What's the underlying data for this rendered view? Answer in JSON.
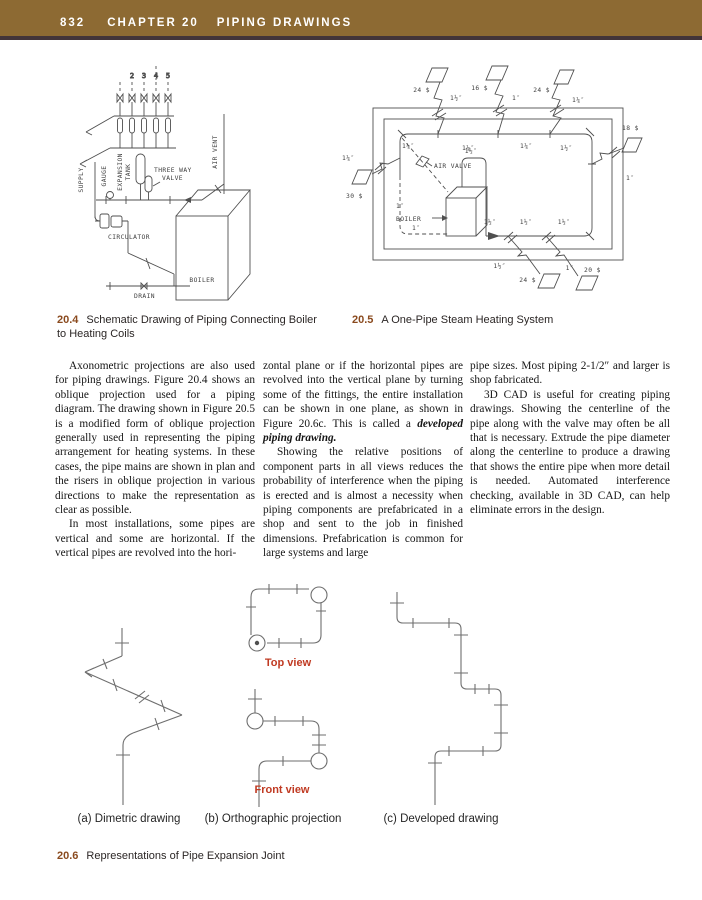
{
  "header": {
    "page": "832",
    "chapter": "CHAPTER 20",
    "title": "PIPING DRAWINGS"
  },
  "colors": {
    "header_bg": "#8d6a33",
    "header_rule": "#423439",
    "caption_number": "#8a4a1e",
    "view_label_red": "#c03a22"
  },
  "fig204": {
    "num": "20.4",
    "caption": "Schematic Drawing of Piping Connecting Boiler to Heating Coils",
    "risers": [
      "2",
      "3",
      "4",
      "5"
    ],
    "supply": "SUPPLY",
    "gauge": "GAUGE",
    "expansion1": "EXPANSION",
    "expansion2": "TANK",
    "three_way1": "THREE WAY",
    "three_way2": "VALVE",
    "air_vent": "AIR VENT",
    "circulator": "CIRCULATOR",
    "drain": "DRAIN",
    "boiler": "BOILER"
  },
  "fig205": {
    "num": "20.5",
    "caption": "A One-Pipe Steam Heating System",
    "air_valve": "AIR VALVE",
    "boiler": "BOILER",
    "rad_top1": "24 $",
    "size_top1": "1½″",
    "rad_top2": "16 $",
    "size_top2": "1″",
    "rad_top3": "24 $",
    "size_top3": "1¼″",
    "rad_right": "18 $",
    "size_right": "1″",
    "rad_left_size": "1¼″",
    "rad_left": "30 $",
    "in_top1": "1¼″",
    "in_top2": "1¼″",
    "in_top3": "1¼″",
    "in_top4": "1½″",
    "left1": "1″",
    "left2": "1″",
    "boiler_out": "1½″",
    "bot1": "1½″",
    "bot2": "1½″",
    "bot3": "1½″",
    "out_bot1": "1½″",
    "rad_bot1": "24 $",
    "out_bot2": "1″",
    "rad_bot2": "20 $"
  },
  "body": {
    "columns": [
      {
        "paragraphs": [
          {
            "text": "Axonometric projections are also used for piping drawings. Figure 20.4 shows an oblique projection used for a piping diagram. The drawing shown in Figure 20.5 is a modified form of oblique projection generally used in representing the piping arrangement for heating systems. In these cases, the pipe mains are shown in plan and the risers in oblique projection in various directions to make the representation as clear as possible."
          },
          {
            "text": "In most installations, some pipes are vertical and some are horizontal. If the vertical pipes are revolved into the hori-"
          }
        ]
      },
      {
        "paragraphs": [
          {
            "text": "zontal plane or if the horizontal pipes are revolved into the vertical plane by turning some of the fittings, the entire installation can be shown in one plane, as shown in Figure 20.6c. This is called a ",
            "emphasis": "developed piping drawing."
          },
          {
            "text": "Showing the relative positions of component parts in all views reduces the probability of interference when the piping is erected and is almost a necessity when piping components are prefabricated in a shop and sent to the job in finished dimensions. Prefabrication is common for large systems and large"
          }
        ]
      },
      {
        "paragraphs": [
          {
            "text": "pipe sizes. Most piping 2-1/2″ and larger is shop fabricated."
          },
          {
            "text": "3D CAD is useful for creating piping drawings. Showing the centerline of the pipe along with the valve may often be all that is necessary. Extrude the pipe diameter along the centerline to produce a drawing that shows the entire pipe when more detail is needed. Automated interference checking, available in 3D CAD, can help eliminate errors in the design."
          }
        ]
      }
    ]
  },
  "fig206": {
    "num": "20.6",
    "caption": "Representations of Pipe Expansion Joint",
    "top_view": "Top view",
    "front_view": "Front view",
    "label_a": "(a) Dimetric drawing",
    "label_b": "(b) Orthographic projection",
    "label_c": "(c) Developed drawing"
  }
}
